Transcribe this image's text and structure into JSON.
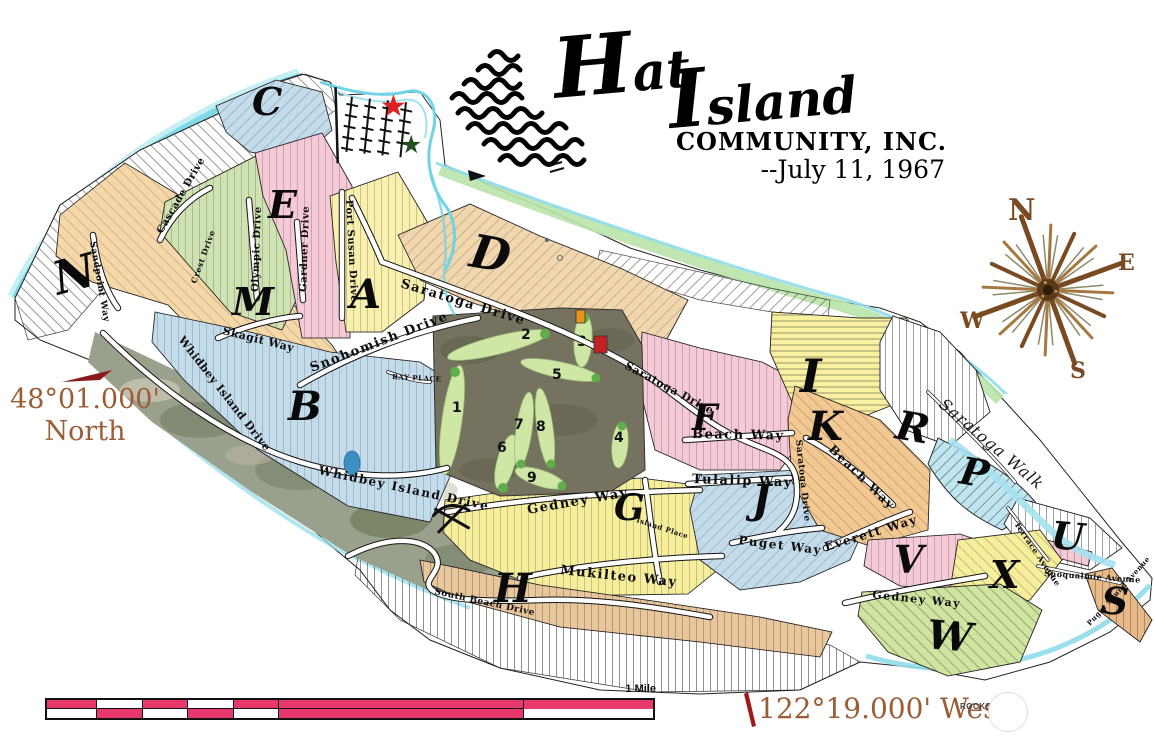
{
  "title": {
    "word1": "Hat",
    "word2": "Island",
    "org": "COMMUNITY, INC.",
    "date": "--July 11, 1967"
  },
  "compass": {
    "north": "N",
    "east": "E",
    "south": "S",
    "west": "W"
  },
  "coordinates": {
    "latitude": "48°01.000'",
    "latitude_word": "North",
    "longitude": "122°19.000' West"
  },
  "scale_bar": {
    "label": "1 Mile"
  },
  "rocks": {
    "label": "ROCKS"
  },
  "sections": [
    {
      "letter": "A"
    },
    {
      "letter": "B"
    },
    {
      "letter": "C"
    },
    {
      "letter": "D"
    },
    {
      "letter": "E"
    },
    {
      "letter": "F"
    },
    {
      "letter": "G"
    },
    {
      "letter": "H"
    },
    {
      "letter": "I"
    },
    {
      "letter": "J"
    },
    {
      "letter": "K"
    },
    {
      "letter": "M"
    },
    {
      "letter": "N"
    },
    {
      "letter": "P"
    },
    {
      "letter": "R"
    },
    {
      "letter": "S"
    },
    {
      "letter": "U"
    },
    {
      "letter": "V"
    },
    {
      "letter": "W"
    },
    {
      "letter": "X"
    }
  ],
  "streets": [
    {
      "name": "Saratoga Drive"
    },
    {
      "name": "Snohomish Drive"
    },
    {
      "name": "Port Susan Drive"
    },
    {
      "name": "Whidbey Island Drive"
    },
    {
      "name": "Whidbey Island Drive"
    },
    {
      "name": "Sandpoint Way"
    },
    {
      "name": "Cascade Drive"
    },
    {
      "name": "Olympic Drive"
    },
    {
      "name": "Gardner Drive"
    },
    {
      "name": "Crest Drive"
    },
    {
      "name": "Skagit Way"
    },
    {
      "name": "RAY PLACE"
    },
    {
      "name": "Saratoga Drive"
    },
    {
      "name": "Saratoga Drive"
    },
    {
      "name": "Beach Way"
    },
    {
      "name": "Beach Way"
    },
    {
      "name": "Tulalip Way"
    },
    {
      "name": "Gedney Way"
    },
    {
      "name": "Gedney Way"
    },
    {
      "name": "Mukilteo Way"
    },
    {
      "name": "Island Place"
    },
    {
      "name": "Puget Way"
    },
    {
      "name": "Everett Way"
    },
    {
      "name": "South Beach Drive"
    },
    {
      "name": "Saratoga Walk"
    },
    {
      "name": "Terrace Avenue"
    },
    {
      "name": "Snoqualmie Avenue"
    },
    {
      "name": "Puget Sound Avenue"
    }
  ],
  "golf": {
    "holes": [
      "1",
      "2",
      "3",
      "4",
      "5",
      "6",
      "7",
      "8",
      "9"
    ]
  },
  "icons": {
    "red_star": "★",
    "green_star": "★"
  },
  "colors": {
    "scale_pink": "#e8396f",
    "coordinate_text": "#9c5c34",
    "compass_brown": "#7a4a22",
    "shore_cyan": "#7fd9e8",
    "shore_green": "#b9e3a8",
    "section_pink": "#f5c9d6",
    "section_blue": "#c3dcec",
    "section_yellow": "#f7ee9c",
    "section_green": "#cfe2b2",
    "section_tan": "#f2d7ae",
    "section_orange": "#f3c991",
    "golf_dark": "#75735f",
    "fairway_green": "#cfe6a5",
    "star_red": "#dd1f1f",
    "star_green": "#234f1e"
  }
}
